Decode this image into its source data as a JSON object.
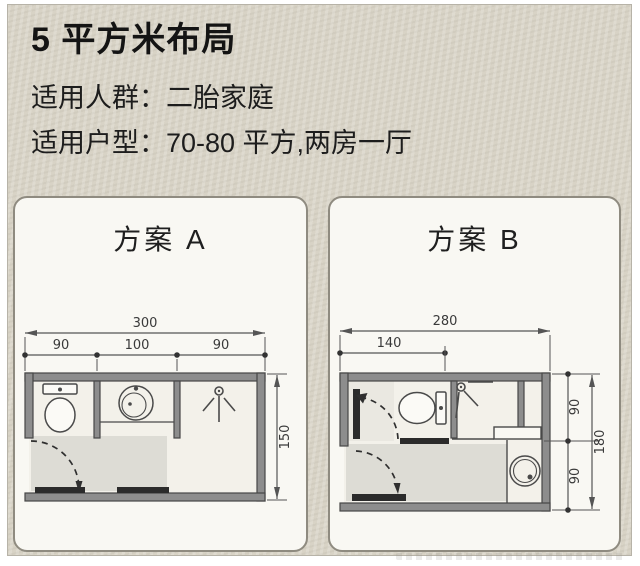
{
  "header": {
    "title": "5 平方米布局",
    "line1": "适用人群：二胎家庭",
    "line2": "适用户型：70-80 平方,两房一厅"
  },
  "plan_a": {
    "title": "方案 A",
    "dim_total_width": "300",
    "dim_seg_left": "90",
    "dim_seg_mid": "100",
    "dim_seg_right": "90",
    "dim_height": "150"
  },
  "plan_b": {
    "title": "方案 B",
    "dim_total_width": "280",
    "dim_seg_left": "140",
    "dim_seg_top": "90",
    "dim_seg_bottom": "90",
    "dim_height": "180"
  },
  "colors": {
    "background": "#d8d3c6",
    "panel": "#f9f8f3",
    "wall": "#8d8d8d",
    "line": "#4a4a4a",
    "dark": "#2b2b2b",
    "text": "#141414"
  }
}
